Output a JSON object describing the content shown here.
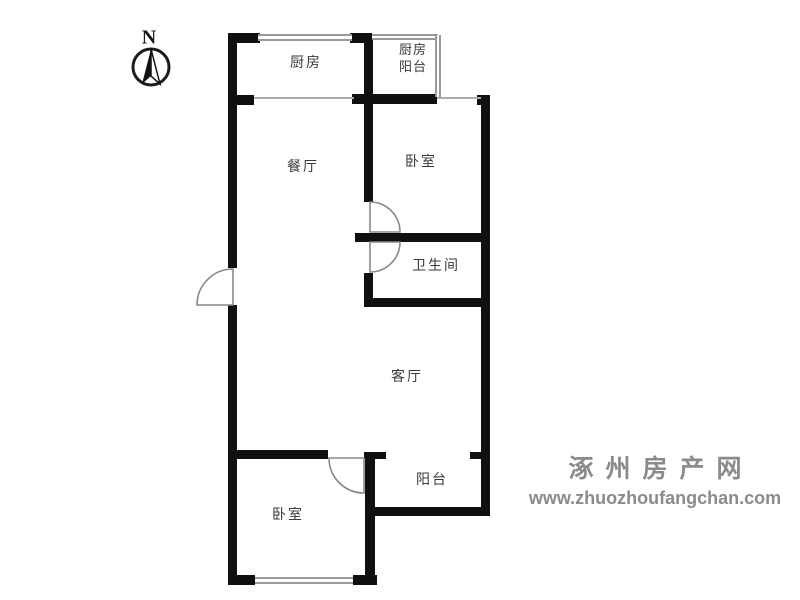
{
  "compass": {
    "north_label": "N"
  },
  "rooms": {
    "kitchen": {
      "label": "厨房"
    },
    "kitchen_balcony": {
      "line1": "厨房",
      "line2": "阳台"
    },
    "dining": {
      "label": "餐厅"
    },
    "bedroom_top": {
      "label": "卧室"
    },
    "bathroom": {
      "label": "卫生间"
    },
    "living": {
      "label": "客厅"
    },
    "balcony": {
      "label": "阳台"
    },
    "bedroom_bottom": {
      "label": "卧室"
    }
  },
  "watermark": {
    "site_name": "涿州房产网",
    "site_url": "www.zhuozhoufangchan.com"
  },
  "colors": {
    "wall": "#101010",
    "window_line": "#9a9a9a",
    "thin_line": "#ababab",
    "door_arc": "#888888",
    "label": "#3a3a3a",
    "watermark": "#8b8b8b"
  }
}
